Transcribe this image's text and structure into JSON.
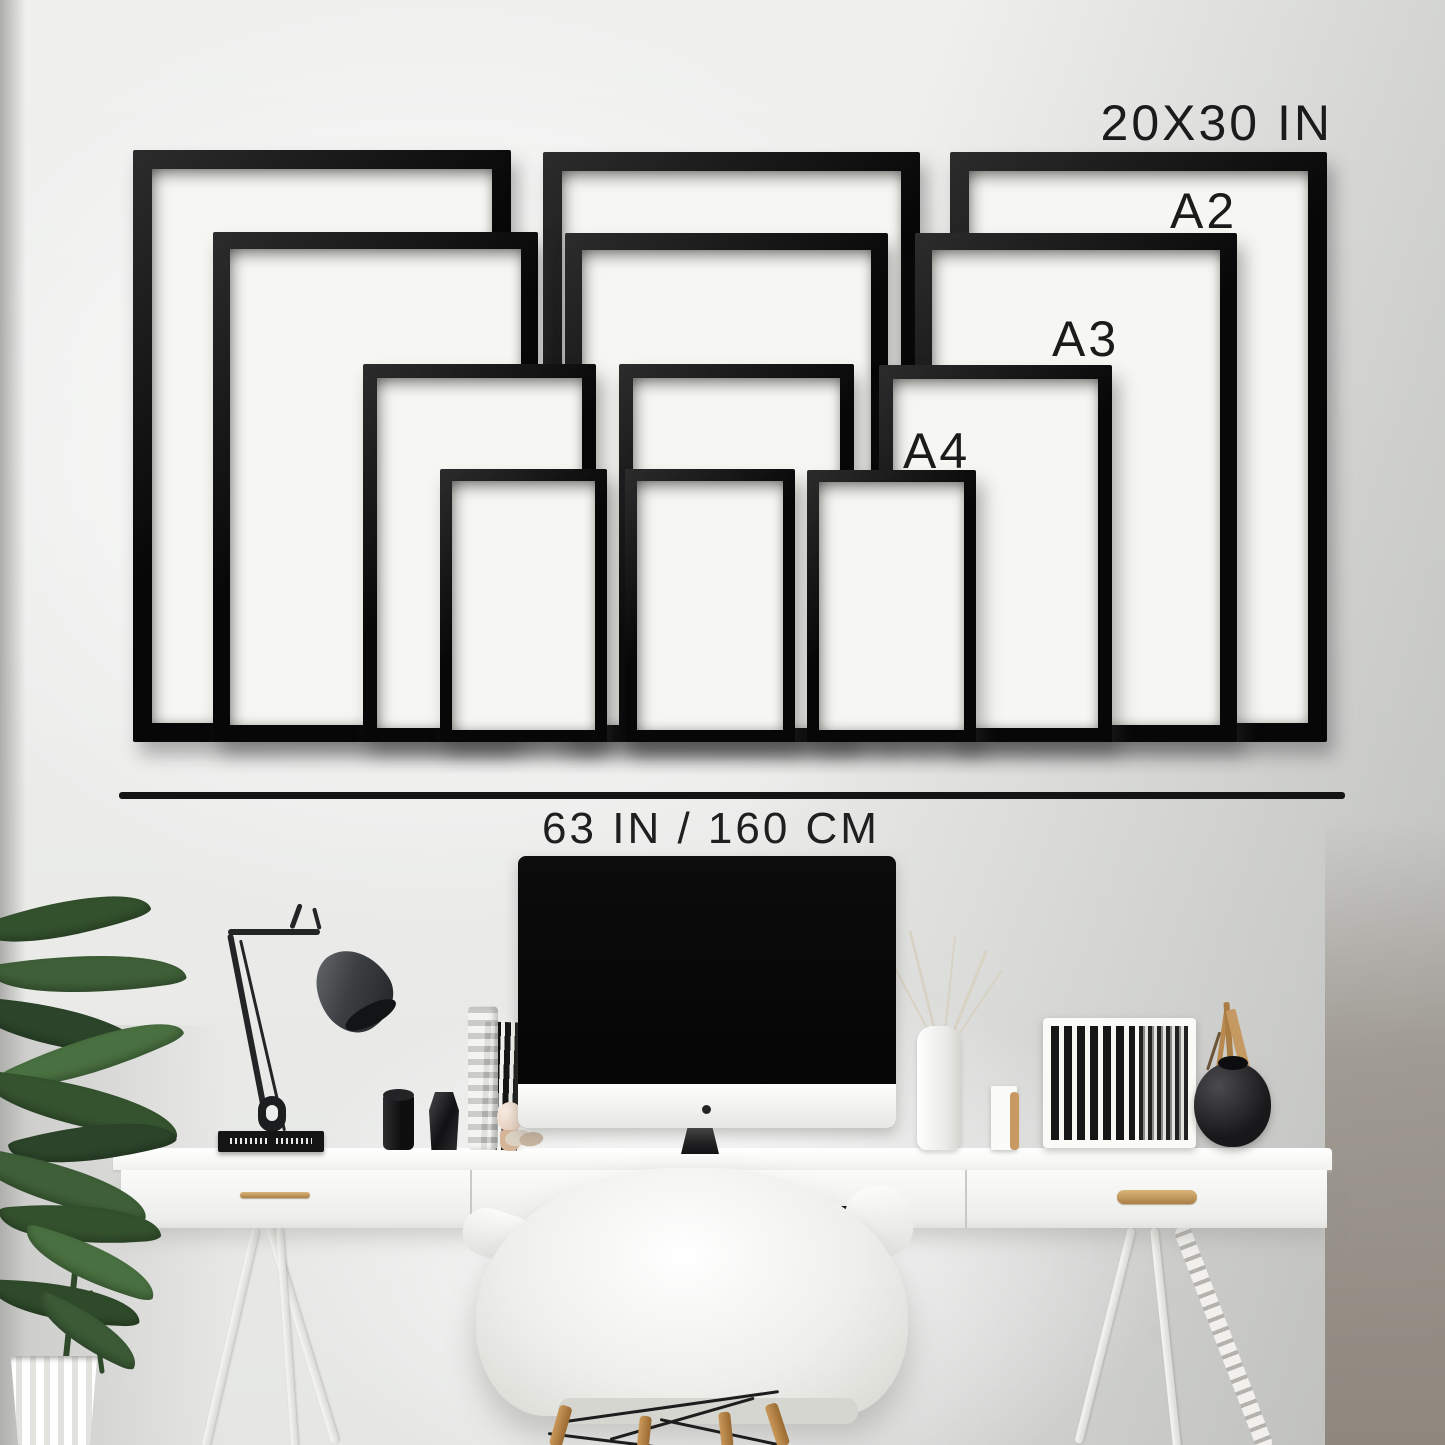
{
  "size_guide": {
    "sizes": [
      {
        "id": "20x30",
        "label": "20X30 IN",
        "count": 3
      },
      {
        "id": "a2",
        "label": "A2",
        "count": 3
      },
      {
        "id": "a3",
        "label": "A3",
        "count": 3
      },
      {
        "id": "a4",
        "label": "A4",
        "count": 3
      }
    ],
    "ruler_label": "63 IN / 160 CM"
  },
  "diagram": {
    "type": "frame-size-guide",
    "frames_total": 12,
    "arrangement": "bottom-aligned wall collage, three frames per size",
    "wall_width_label": "63 IN / 160 CM"
  },
  "colors": {
    "frame": "#0f0f0f",
    "frame_mat": "#f6f6f2",
    "label_text": "#1b1b1b",
    "ruler_line": "#141414",
    "wall_light": "#f0f1ef",
    "wall_shaded": "#c7c9c8",
    "desk_white": "#fbfbf9",
    "brass_handle": "#c09a66",
    "plant_green": "#3b5a35",
    "wood_leg": "#b5813f"
  },
  "scene_items": [
    "potted-plant",
    "desk-lamp",
    "imac-computer",
    "records-stack",
    "black-cup",
    "black-vase",
    "glass-vase",
    "white-vase-dried-branches",
    "card-and-figurine",
    "record-organizer",
    "round-black-vase-with-brushes",
    "white-desk",
    "shell-armchair",
    "brass-drawer-handles"
  ]
}
